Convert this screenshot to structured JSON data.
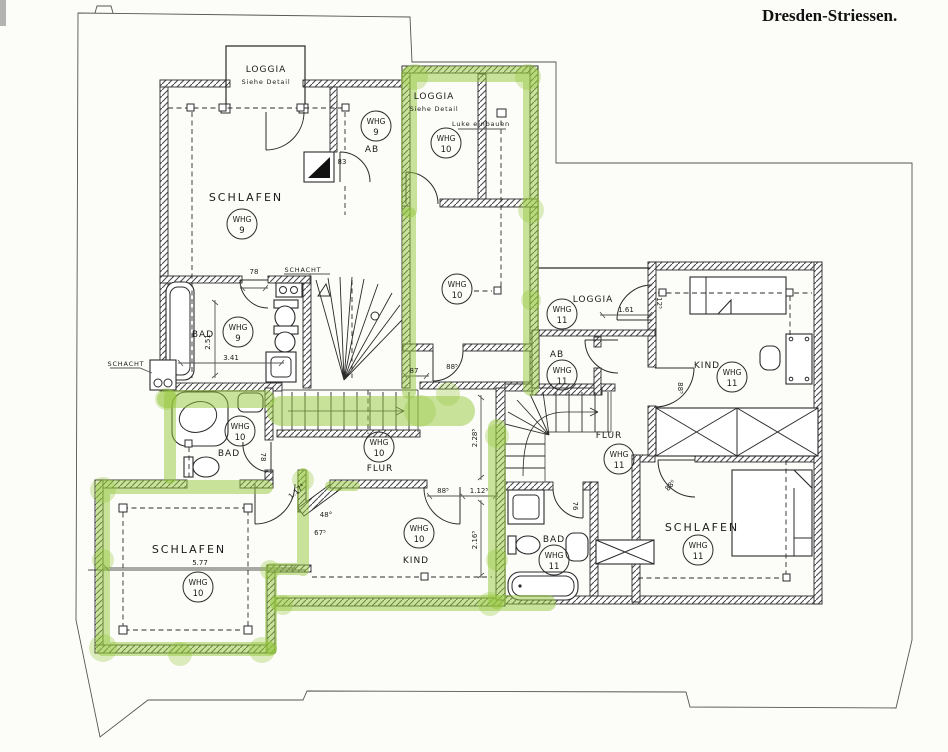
{
  "title": "Dresden-Striessen.",
  "colors": {
    "highlight": "#93c73e",
    "ink": "#2b2b2b",
    "paper": "#fcfcf9"
  },
  "badge": {
    "unit": "WHG",
    "no9": "9",
    "no10": "10",
    "no11": "11"
  },
  "rooms": {
    "loggia9": {
      "label": "LOGGIA",
      "sub": "Siehe Detail"
    },
    "schlafen9": {
      "label": "SCHLAFEN"
    },
    "ab9": {
      "label": "AB"
    },
    "bad9": {
      "label": "BAD"
    },
    "loggia10": {
      "label": "LOGGIA",
      "sub": "Siehe Detail",
      "note": "Luke einbauen"
    },
    "bad10": {
      "label": "BAD"
    },
    "flur10": {
      "label": "FLUR"
    },
    "schlafen10": {
      "label": "SCHLAFEN"
    },
    "kind10": {
      "label": "KIND"
    },
    "loggia11": {
      "label": "LOGGIA"
    },
    "ab11": {
      "label": "AB"
    },
    "kind11": {
      "label": "KIND"
    },
    "flur11": {
      "label": "FLUR"
    },
    "bad11": {
      "label": "BAD"
    },
    "schlafen11": {
      "label": "SCHLAFEN"
    }
  },
  "annotations": {
    "schacht_top": "SCHACHT",
    "schacht_left": "SCHACHT"
  },
  "dims": {
    "bad9_door": "78",
    "bad9_width": "3.41",
    "bad9_height": "2.51",
    "ab9_door": "83",
    "corridor_len": "87",
    "corridor_door": "88⁵",
    "flur_door": "88⁵",
    "flur_pass": "1.12⁵",
    "flur_height": "2.28⁵",
    "kind10_height": "2.16⁵",
    "schlafen10_width": "5.77",
    "angle_a": "48°",
    "angle_b": "67⁵",
    "diag": "1.17⁴",
    "loggia11_door": "1.61",
    "kind11_door": "12⁵",
    "kind11_lower_door": "88⁵",
    "bad11_door": "76",
    "bad10_door": "78",
    "schlafen11_door": "88⁵"
  }
}
